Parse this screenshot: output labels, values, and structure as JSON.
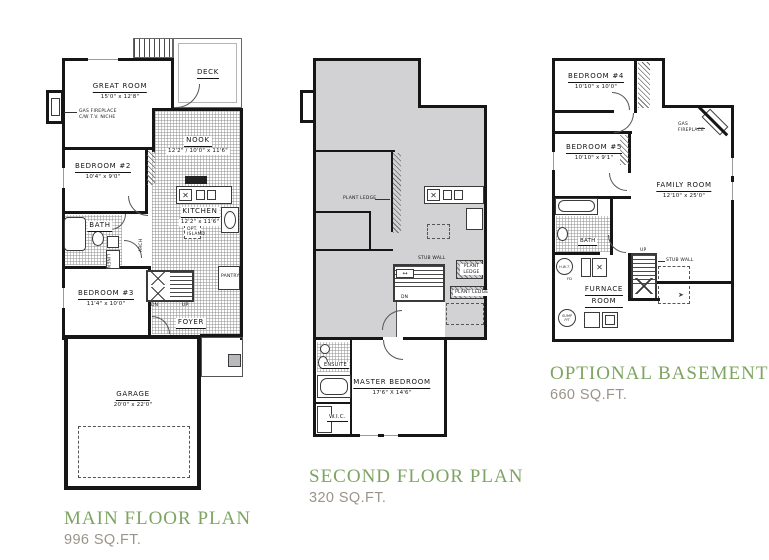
{
  "sheet": {
    "background": "#ffffff",
    "wall_color": "#161616",
    "open_below_fill": "#d2d2d4",
    "title_color": "#7da462",
    "area_color": "#9b948a"
  },
  "icons": {
    "burner_x": "✕",
    "arrow_lr": "↔",
    "arrow_right": "➤"
  },
  "plans": {
    "main": {
      "title": "MAIN FLOOR PLAN",
      "area": "996 SQ.FT.",
      "rooms": {
        "great_room": {
          "name": "GREAT ROOM",
          "dims": "15'0\" x 12'8\""
        },
        "deck": {
          "name": "DECK"
        },
        "nook": {
          "name": "NOOK",
          "dims": "12'2\" / 10'0\" x 11'6\""
        },
        "bedroom2": {
          "name": "BEDROOM #2",
          "dims": "10'4\" x 9'0\""
        },
        "kitchen": {
          "name": "KITCHEN",
          "dims": "12'2\" x 11'6\""
        },
        "bath": {
          "name": "BATH"
        },
        "bedroom3": {
          "name": "BEDROOM #3",
          "dims": "11'4\" x 10'0\""
        },
        "foyer": {
          "name": "FOYER"
        },
        "garage": {
          "name": "GARAGE",
          "dims": "20'0\" x 22'0\""
        }
      },
      "notes": {
        "fireplace_line1": "GAS FIREPLACE",
        "fireplace_line2": "C/W T.V. NICHE",
        "opt_island_line1": "OPT.",
        "opt_island_line2": "ISLAND",
        "pantry": "PANTRY",
        "linen": "LINEN",
        "arch": "ARCH",
        "up": "UP",
        "dn": "DN"
      }
    },
    "second": {
      "title": "SECOND FLOOR PLAN",
      "area": "320 SQ.FT.",
      "rooms": {
        "master_bedroom": {
          "name": "MASTER BEDROOM",
          "dims": "17'6\" X 14'6\""
        },
        "ensuite": {
          "name": "ENSUITE"
        },
        "wic": {
          "name": "W.I.C."
        }
      },
      "notes": {
        "plant_ledge": "PLANT LEDGE",
        "stub_wall": "STUB WALL",
        "dn": "DN"
      }
    },
    "basement": {
      "title": "OPTIONAL BASEMENT PLAN",
      "area": "660 SQ.FT.",
      "rooms": {
        "bedroom4": {
          "name": "BEDROOM #4",
          "dims": "10'10\" x 10'0\""
        },
        "bedroom5": {
          "name": "BEDROOM #5",
          "dims": "10'10\" x 9'1\""
        },
        "family_room": {
          "name": "FAMILY ROOM",
          "dims": "12'10\" x 25'0\""
        },
        "bath": {
          "name": "BATH"
        },
        "furnace_room": {
          "line1": "FURNACE",
          "line2": "ROOM"
        }
      },
      "notes": {
        "gas_fireplace_line1": "GAS",
        "gas_fireplace_line2": "FIREPLACE",
        "stub_wall": "STUB WALL",
        "up": "UP",
        "hwt": "H.W.T.",
        "fd": "FD",
        "sump": "SUMP PIT"
      }
    }
  }
}
